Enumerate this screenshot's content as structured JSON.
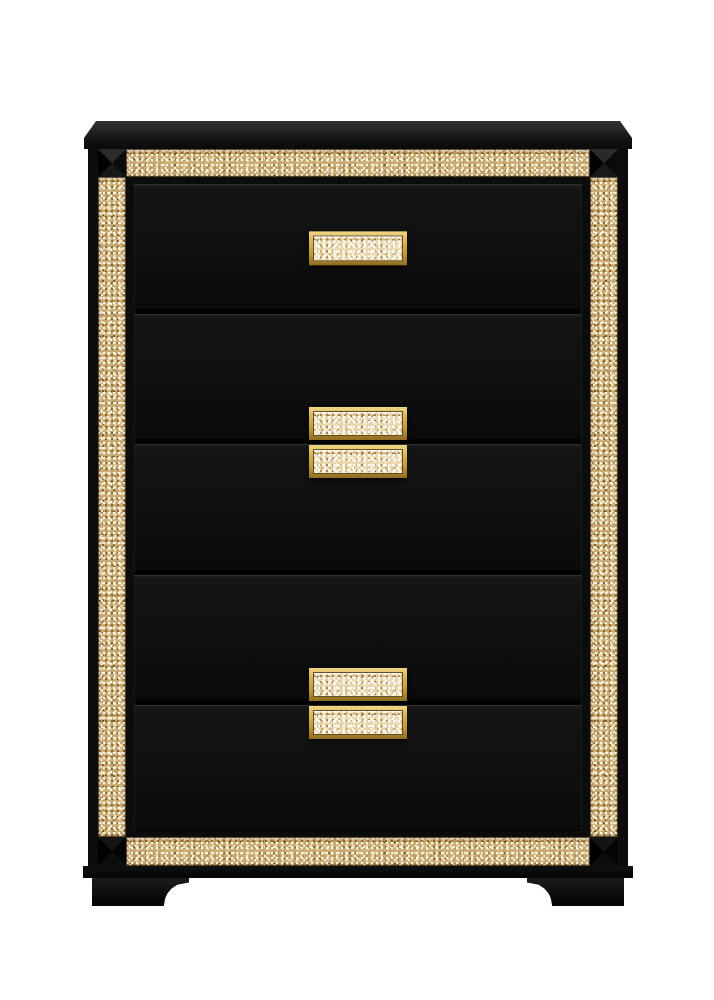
{
  "image": {
    "type": "product-photo",
    "subject": "Glam five-drawer chest in black finish with gold faux-crystal glitter trim, gold glitter handles, beveled black top, faceted corner accents and bracket feet on a white background",
    "background": "#ffffff"
  },
  "palette": {
    "background": "#ffffff",
    "body_black": "#0c0c0c",
    "drawer_face": "#101010",
    "gold_frame": "#d9b453",
    "gold_frame_dark": "#8f6c22",
    "glitter_base": "#c7aa74",
    "glitter_bright_base": "#e8d6ad",
    "sparkle_white": "#fff8e7",
    "glitter_dark_fleck": "#8a6527"
  },
  "structure": {
    "drawer_count": 5,
    "handle_count": 5,
    "feet_count": 2,
    "corner_accent_count": 4,
    "trim_bands": [
      "top",
      "left",
      "right",
      "bottom"
    ],
    "drawers": [
      {
        "handle": "center"
      },
      {
        "handle": "bottom"
      },
      {
        "handle": "top"
      },
      {
        "handle": "bottom"
      },
      {
        "handle": "top"
      }
    ]
  }
}
